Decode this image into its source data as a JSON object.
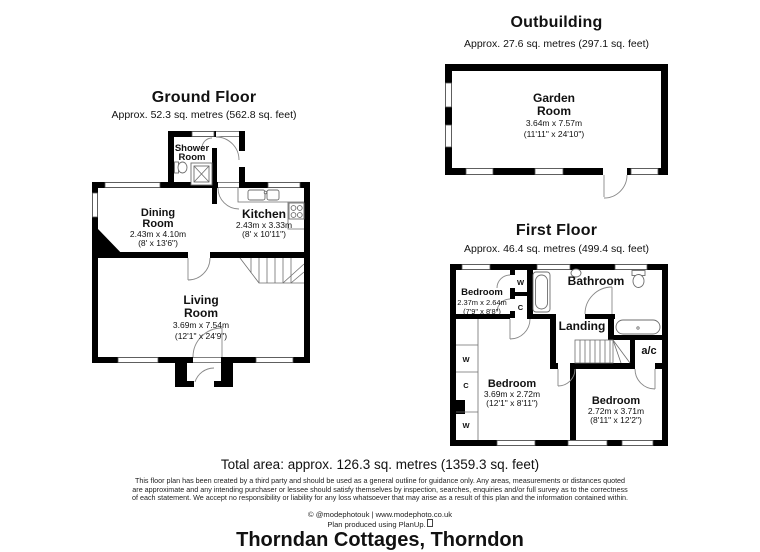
{
  "property": {
    "title": "Thorndan Cottages, Thorndon",
    "total_area": "Total area: approx. 126.3 sq. metres (1359.3 sq. feet)",
    "disclaimer_lines": [
      "This floor plan has been created by a third party and should be used as a general outline for guidance only. Any areas, measurements or distances quoted",
      "are approximate and any intending purchaser or lessee should satisfy themselves by inspection, searches, enquiries and/or full survey as to the correctness",
      "of each statement. We accept no responsibility or liability for any loss whatsoever that may arise as a result of this plan and the information contained within."
    ],
    "credit": "© @modephotouk | www.modephoto.co.uk",
    "produced": "Plan produced using PlanUp."
  },
  "floors": {
    "ground": {
      "title": "Ground Floor",
      "subtitle": "Approx. 52.3 sq. metres (562.8 sq. feet)",
      "rooms": {
        "shower": {
          "line1": "Shower",
          "line2": "Room"
        },
        "dining": {
          "line1": "Dining",
          "line2": "Room",
          "metric": "2.43m x 4.10m",
          "imperial": "(8' x 13'6\")"
        },
        "kitchen": {
          "line1": "Kitchen",
          "metric": "2.43m x 3.33m",
          "imperial": "(8' x 10'11\")"
        },
        "living": {
          "line1": "Living",
          "line2": "Room",
          "metric": "3.69m x 7.54m",
          "imperial": "(12'1\" x 24'9\")"
        }
      }
    },
    "first": {
      "title": "First Floor",
      "subtitle": "Approx. 46.4 sq. metres (499.4 sq. feet)",
      "rooms": {
        "bedroom1": {
          "line1": "Bedroom",
          "metric": "2.37m x 2.64m",
          "imperial": "(7'9\" x 8'8\")"
        },
        "bathroom": {
          "line1": "Bathroom"
        },
        "landing": {
          "line1": "Landing"
        },
        "ac": {
          "line1": "a/c"
        },
        "bedroom2": {
          "line1": "Bedroom",
          "metric": "3.69m x 2.72m",
          "imperial": "(12'1\" x 8'11\")"
        },
        "bedroom3": {
          "line1": "Bedroom",
          "metric": "2.72m x 3.71m",
          "imperial": "(8'11\" x 12'2\")"
        },
        "closets": {
          "w1": "W",
          "c1": "C",
          "w2": "W",
          "c2": "C",
          "w3": "W"
        }
      }
    },
    "outbuilding": {
      "title": "Outbuilding",
      "subtitle": "Approx. 27.6 sq. metres (297.1 sq. feet)",
      "rooms": {
        "garden": {
          "line1": "Garden",
          "line2": "Room",
          "metric": "3.64m x 7.57m",
          "imperial": "(11'11\" x 24'10\")"
        }
      }
    }
  },
  "colors": {
    "wall": "#000000",
    "background": "#ffffff",
    "line": "#6e6e6e"
  }
}
